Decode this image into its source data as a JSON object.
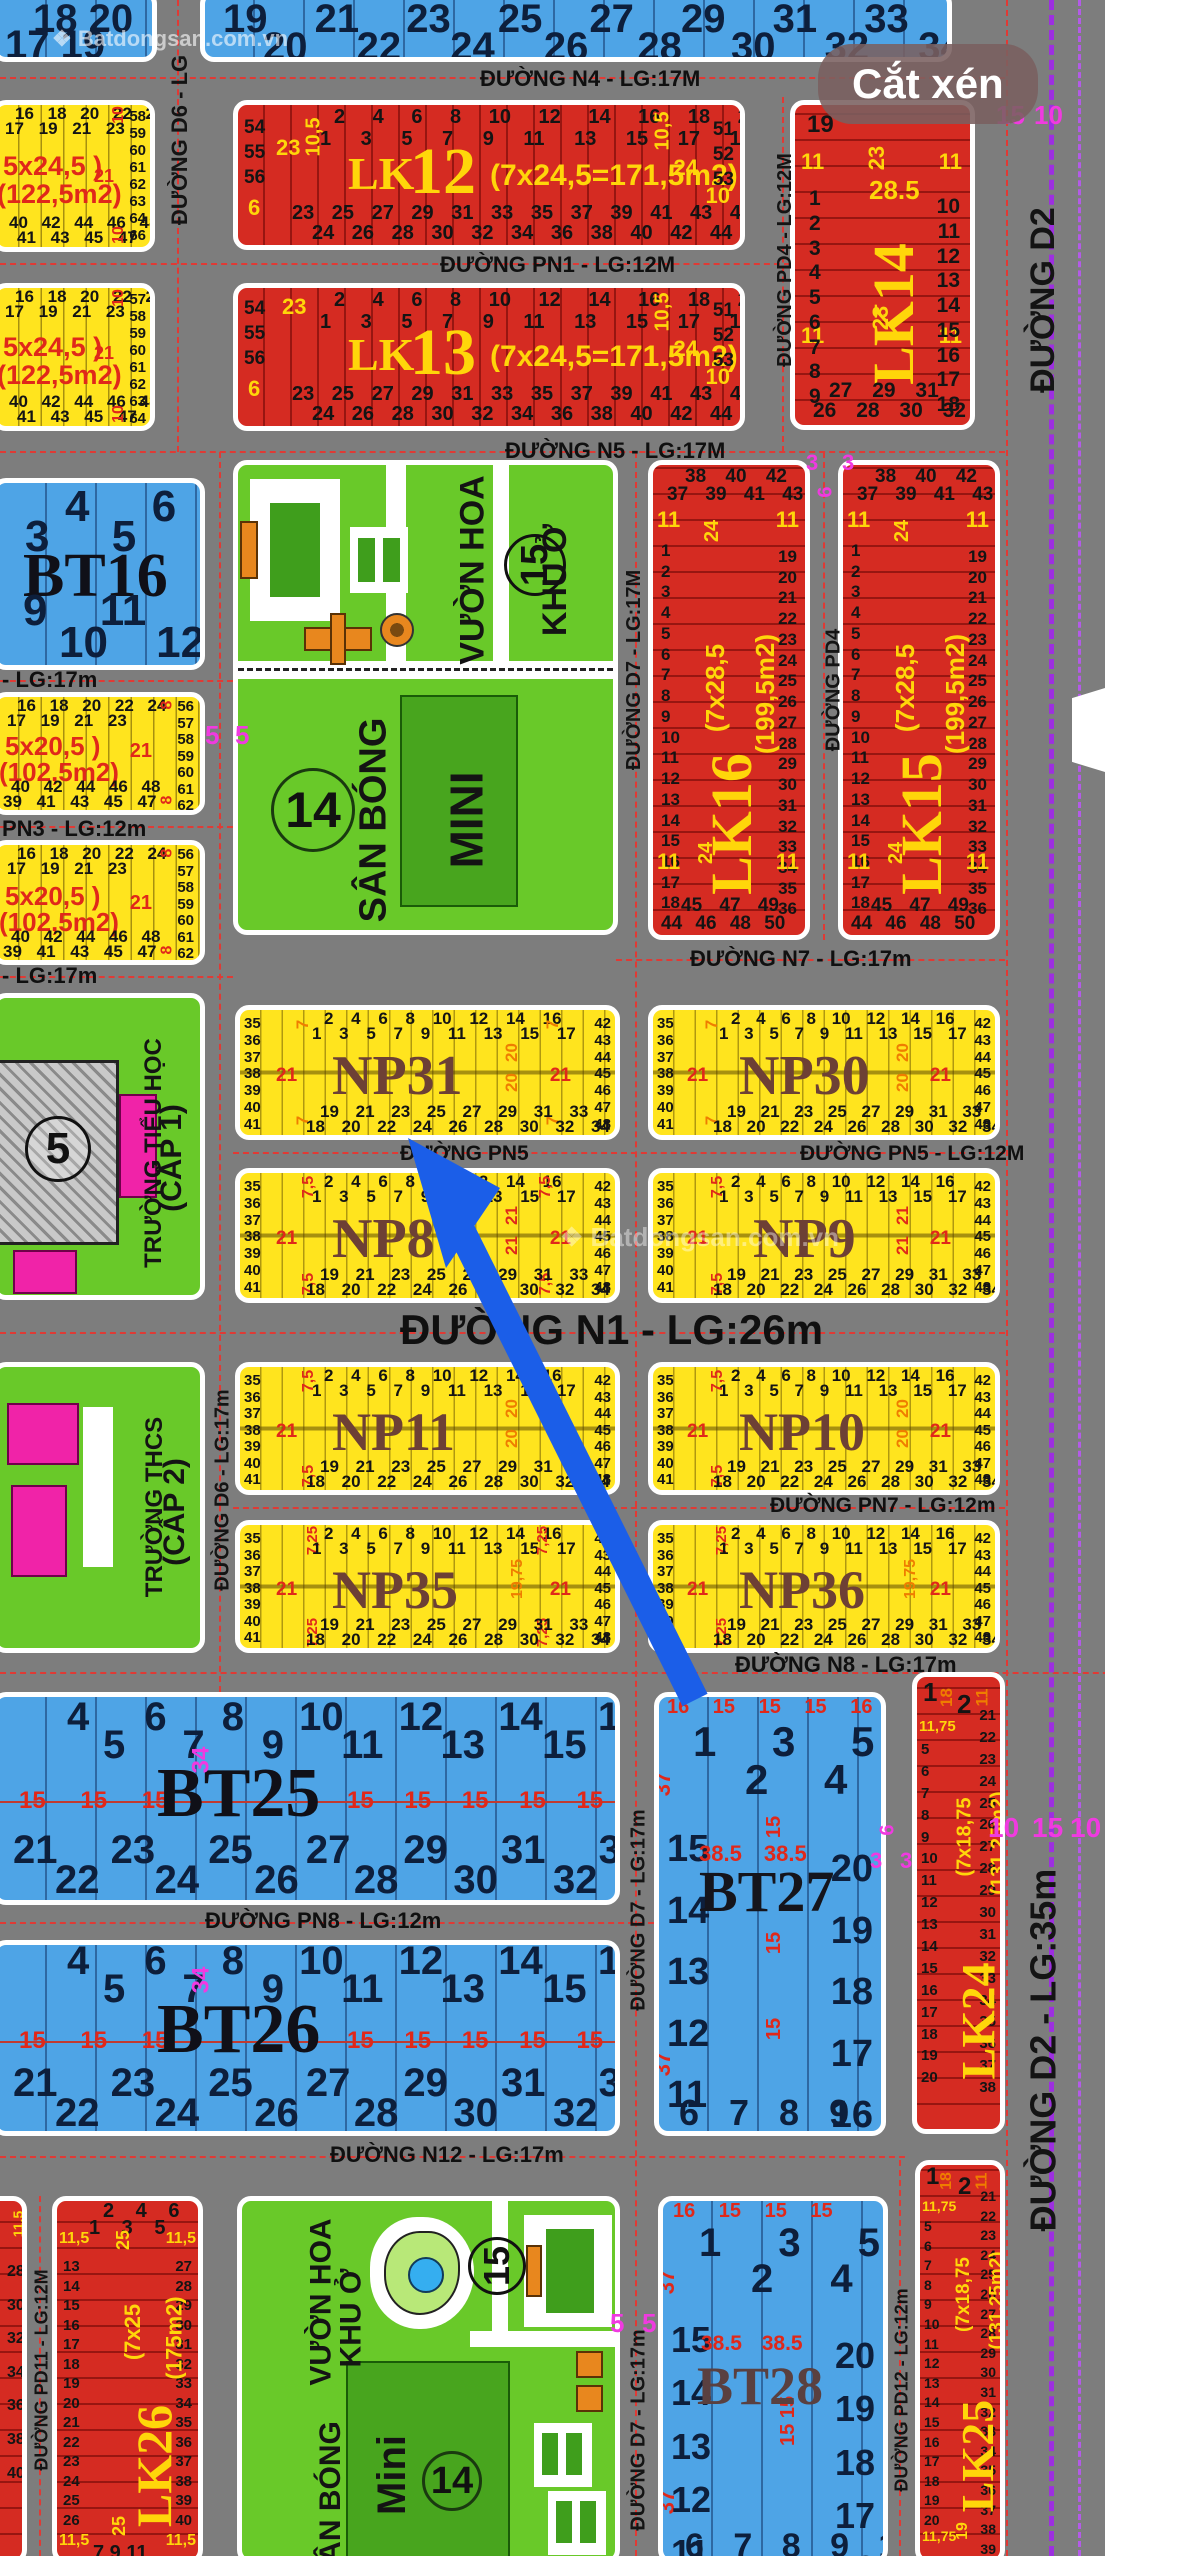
{
  "badge": {
    "label": "Cắt xén"
  },
  "watermark": {
    "brand": "Batdongsan.com.vn",
    "logo": "❖"
  },
  "streets": {
    "n4": "ĐƯỜNG N4 - LG:17M",
    "pn1": "ĐƯỜNG PN1 - LG:12M",
    "n5": "ĐƯỜNG N5 - LG:17M",
    "n7": "ĐƯỜNG N7 - LG:17m",
    "pn5a": "ĐƯỜNG PN5",
    "pn5b": "ĐƯỜNG PN5 - LG:12M",
    "n1": "ĐƯỜNG N1    -    LG:26m",
    "pn7": "ĐƯỜNG PN7 - LG:12m",
    "n8": "ĐƯỜNG N8 - LG:17m",
    "pn8": "ĐƯỜNG PN8 - LG:12m",
    "n12": "ĐƯỜNG N12 - LG:17m",
    "pn3": "PN3 - LG:12m",
    "lg17a": "- LG:17m",
    "lg17b": "- LG:17m",
    "d6top": "ĐƯỜNG D6 - LG",
    "d6": "ĐƯỜNG D6 - LG:17m",
    "d7a": "ĐƯỜNG D7 - LG:17M",
    "d7b": "ĐƯỜNG D7 - LG:17m",
    "d7c": "ĐƯỜNG D7 - LG:17m",
    "pd4a": "ĐƯỜNG PD4 - LG:12M",
    "pd4b": "ĐƯỜNG PD4",
    "pd11": "ĐƯỜNG PD11 - LG:12M",
    "pd12": "ĐƯỜNG PD12 - LG:12m",
    "d2a": "ĐƯỜNG D2",
    "d2b": "ĐƯỜNG D2  -  LG:35m"
  },
  "marks": {
    "m5a": "5",
    "m5b": "5",
    "m5c": "5",
    "m5d": "5",
    "m34a": "34",
    "m34b": "34",
    "m3a": "3",
    "m3b": "3",
    "m3c": "3",
    "m3d": "3",
    "m6a": "6",
    "m6b": "6",
    "tr15": "15",
    "tr10": "10",
    "r10a": "10",
    "r15": "15",
    "r10b": "10"
  },
  "blocks": {
    "blue_left": {
      "top1": "18   20",
      "top2": "17   19"
    },
    "blue_right": {
      "top1": "19   21   23   25   27   29   31   33   35",
      "top2": "20   22   24   26   28   30   32   34   36"
    },
    "lk12": {
      "name": "LK",
      "num": "12",
      "dims": "(7x24,5=171,5m2)",
      "top1": "2 4 6 8 10 12 14 16 18 20 22",
      "top2": "1 3 5 7 9 11 13 15 17 19 21",
      "bot1": "23 25 27 29 31 33 35 37 39 41 43 45 47 49",
      "bot2": "24 26 28 30 32 34 36 38 40 42 44 46 48 50",
      "left": "54\n55\n56",
      "lY1": "23",
      "lY2": "6",
      "ldim": "10,5",
      "right": "51\n52\n53",
      "rY1": "24",
      "rY2": "10",
      "rdim": "10,5"
    },
    "lk13": {
      "name": "LK",
      "num": "13",
      "dims": "(7x24,5=171,5m2)",
      "top1": "2 4 6 8 10 12 14 16 18 20 22",
      "top2": "1 3 5 7 9 11 13 15 17 19 21",
      "bot1": "23 25 27 29 31 33 35 37 39 41 43 45 47 49",
      "bot2": "24 26 28 30 32 34 36 38 40 42 44 46 48 50",
      "left": "54\n55\n56",
      "lY1": "23",
      "lY2": "6",
      "right": "51\n52\n53",
      "rY1": "24",
      "rY2": "10",
      "rdim": "10,5"
    },
    "lk14": {
      "name": "LK14",
      "tl": "19",
      "d1": "28.5",
      "d2": "23",
      "d3": "23",
      "c1": "11",
      "c2": "11",
      "c3": "11",
      "c4": "11",
      "left": "1\n2\n3\n4\n5\n6\n7\n8\n9",
      "right": "10\n11\n12\n13\n14\n15\n16\n17\n18",
      "bot1": "27 29 31",
      "bot2": "26 28 30 32"
    },
    "y245a": {
      "d1": "5x24,5 )",
      "d2": "(122,5m2)",
      "top1": "16 18 20 22 24",
      "top2": "17 19 21 23",
      "bot1": "40 42 44 46 48",
      "bot2": "41 43 45 47",
      "col": "58\n59\n60\n61\n62\n63\n64\n66",
      "side": "21",
      "dim": "10",
      "dim2": "10"
    },
    "y245b": {
      "d1": "5x24,5 )",
      "d2": "(122,5m2)",
      "top1": "16 18 20 22 24",
      "top2": "17 19 21 23",
      "bot1": "40 42 44 46 48",
      "bot2": "41 43 45 47",
      "col": "57\n58\n59\n60\n61\n62\n63\n64",
      "side": "21",
      "dim": "10",
      "dim2": "10"
    },
    "bt16": {
      "name": "BT16",
      "top1": "4    6",
      "top2": "3    5",
      "bot1": "9     11",
      "bot2": "10     12"
    },
    "y205a": {
      "d1": "5x20,5 )",
      "d2": "(102,5m2)",
      "top1": "16 18 20 22 24",
      "top2": "17 19 21 23",
      "bot1": "40 42 44 46 48",
      "bot2": "39 41 43 45 47",
      "col": "56\n57\n58\n59\n60\n61\n62",
      "side": "21",
      "dim": "8",
      "dim2": "8"
    },
    "y205b": {
      "d1": "5x20,5 )",
      "d2": "(102,5m2)",
      "top1": "16 18 20 22 24",
      "top2": "17 19 21 23",
      "bot1": "40 42 44 46 48",
      "bot2": "39 41 43 45 47",
      "col": "56\n57\n58\n59\n60\n61\n62",
      "side": "21",
      "dim": "8",
      "dim2": "8"
    },
    "school1": {
      "l1": "TRƯỜNG TIỂU HỌC",
      "l2": "(CẤP 1)",
      "num": "5"
    },
    "school2": {
      "l1": "TRƯỜNG THCS",
      "l2": "(CẤP 2)"
    },
    "park1": {
      "a": "VƯỜN HOA",
      "b": "KHU Ở",
      "c": "SÂN BÓNG",
      "d": "MINI",
      "n15": "15",
      "n14": "14"
    },
    "park2": {
      "a": "VƯỜN HOA",
      "b": "KHU Ở",
      "c": "SÂN BÓNG",
      "d": "Mini",
      "n15": "15",
      "n14": "14"
    },
    "lk16": {
      "name": "LK16",
      "d1": "(7x28,5",
      "d2": "(199,5m2)",
      "top1": "38 40 42",
      "top2": "37 39 41 43",
      "bot1": "45 47 49",
      "bot2": "44 46 48 50",
      "left": "1\n2\n3\n4\n5\n6\n7\n8\n9\n10\n11\n12\n13\n14\n15\n16\n17\n18",
      "right": "19\n20\n21\n22\n23\n24\n25\n26\n27\n28\n29\n30\n31\n32\n33\n34\n35\n36",
      "c1": "11",
      "c2": "11",
      "c3": "11",
      "c4": "11",
      "m1": "24",
      "m2": "24"
    },
    "lk15": {
      "name": "LK15",
      "d1": "(7x28,5",
      "d2": "(199,5m2)",
      "top1": "38 40 42",
      "top2": "37 39 41 43",
      "bot1": "45 47 49",
      "bot2": "44 46 48 50",
      "left": "1\n2\n3\n4\n5\n6\n7\n8\n9\n10\n11\n12\n13\n14\n15\n16\n17\n18",
      "right": "19\n20\n21\n22\n23\n24\n25\n26\n27\n28\n29\n30\n31\n32\n33\n34\n35\n36",
      "c1": "11",
      "c2": "11",
      "c3": "11",
      "c4": "11",
      "m1": "24",
      "m2": "24"
    },
    "npRows": {
      "left": "35\n36\n37\n38\n39\n40\n41",
      "right": "42\n43\n44\n45\n46\n47\n48",
      "top1": "2 4 6 8 10 12 14 16",
      "top2": "1 3 5 7 9 11 13 15 17",
      "bot1": "19 21 23 25 27 29 31 33",
      "bot2": "18 20 22 24 26 28 30 32 34",
      "s": "21"
    },
    "np31": {
      "name": "NP31",
      "c": "7",
      "m1": "20",
      "m2": "20"
    },
    "np30": {
      "name": "NP30",
      "c": "7",
      "m1": "20",
      "m2": "20"
    },
    "np8": {
      "name": "NP8",
      "c": "7,5",
      "m1": "21",
      "m2": "21"
    },
    "np9": {
      "name": "NP9",
      "c": "7,5",
      "m1": "21",
      "m2": "21"
    },
    "np11": {
      "name": "NP11",
      "c": "7,5",
      "m1": "20",
      "m2": "20"
    },
    "np10": {
      "name": "NP10",
      "c": "7,5",
      "m1": "20",
      "m2": "20"
    },
    "np35": {
      "name": "NP35",
      "c": "7,25",
      "m1": "19,75"
    },
    "np36": {
      "name": "NP36",
      "c": "7,25",
      "m1": "19,75"
    },
    "btRows": {
      "top1": "4 6 8 10 12 14 16",
      "top2": "5 7 9 11 13 15 17",
      "m1": "15 15 15",
      "m2": "15 15 15 15 15 16",
      "bot1": "21 23 25 27 29 31 33",
      "bot2": "22 24 26 28 30 32 34"
    },
    "bt25": {
      "name": "BT25"
    },
    "bt26": {
      "name": "BT26"
    },
    "bt27": {
      "name": "BT27",
      "wtop": "16 15 15 15 16",
      "top1": "1  3  5",
      "top2": "2  4",
      "left": "15\n14\n13\n12\n11",
      "right": "20\n19\n18\n17\n16",
      "d1": "38.5  38.5",
      "d2": "15",
      "d3": "15",
      "d4": "15",
      "s": "37",
      "s2": "37",
      "bot": "6  7  8  9  10"
    },
    "bt28": {
      "name": "BT28",
      "wtop": "16 15 15 15",
      "top1": "1  3  5",
      "top2": "2  4",
      "left": "15\n14\n13\n12\n11",
      "right": "20\n19\n18\n17\n16",
      "d1": "38.5  38.5",
      "d2": "15  15",
      "s": "37",
      "s2": "37",
      "bot": "6  7  8  9  10"
    },
    "lk24": {
      "name": "LK24",
      "d1": "(7x18,75",
      "d2": "(131,25m2)",
      "t1": "1",
      "t2": "2",
      "t18": "18",
      "t11": "11",
      "t1175": "11,75",
      "left": "5\n6\n7\n8\n9\n10\n11\n12\n13\n14\n15\n16\n17\n18\n19\n20",
      "right": "21\n22\n23\n24\n25\n26\n27\n28\n29\n30\n31\n32\n33\n34\n35\n36\n37\n38"
    },
    "lk25": {
      "name": "LK25",
      "d1": "(7x18,75",
      "d2": "(131,25m2)",
      "t1": "1",
      "t2": "2",
      "t18": "18",
      "t11": "11",
      "t1175": "11,75",
      "b19": "19",
      "left": "5\n6\n7\n8\n9\n10\n11\n12\n13\n14\n15\n16\n17\n18\n19\n20",
      "right": "21\n22\n23\n24\n25\n26\n27\n28\n29\n30\n31\n32\n33\n34\n35\n36\n37\n38\n39"
    },
    "lk26": {
      "name": "LK26",
      "d1": "(7x25",
      "d2": "(175m2)",
      "m": "25",
      "m2": "25",
      "c1": "11,5",
      "c2": "11,5",
      "c3": "11,5",
      "c4": "11,5",
      "top1": "2 4 6",
      "top2": "1 3 5",
      "left": "13\n14\n15\n16\n17\n18\n19\n20\n21\n22\n23\n24\n25\n26",
      "right": "27\n28\n29\n30\n31\n32\n33\n34\n35\n36\n37\n38\n39\n40",
      "bot": "7   9   11"
    },
    "red_bl": {
      "col": "28\n30\n32\n34\n36\n38\n40",
      "dim": "11,5"
    }
  }
}
